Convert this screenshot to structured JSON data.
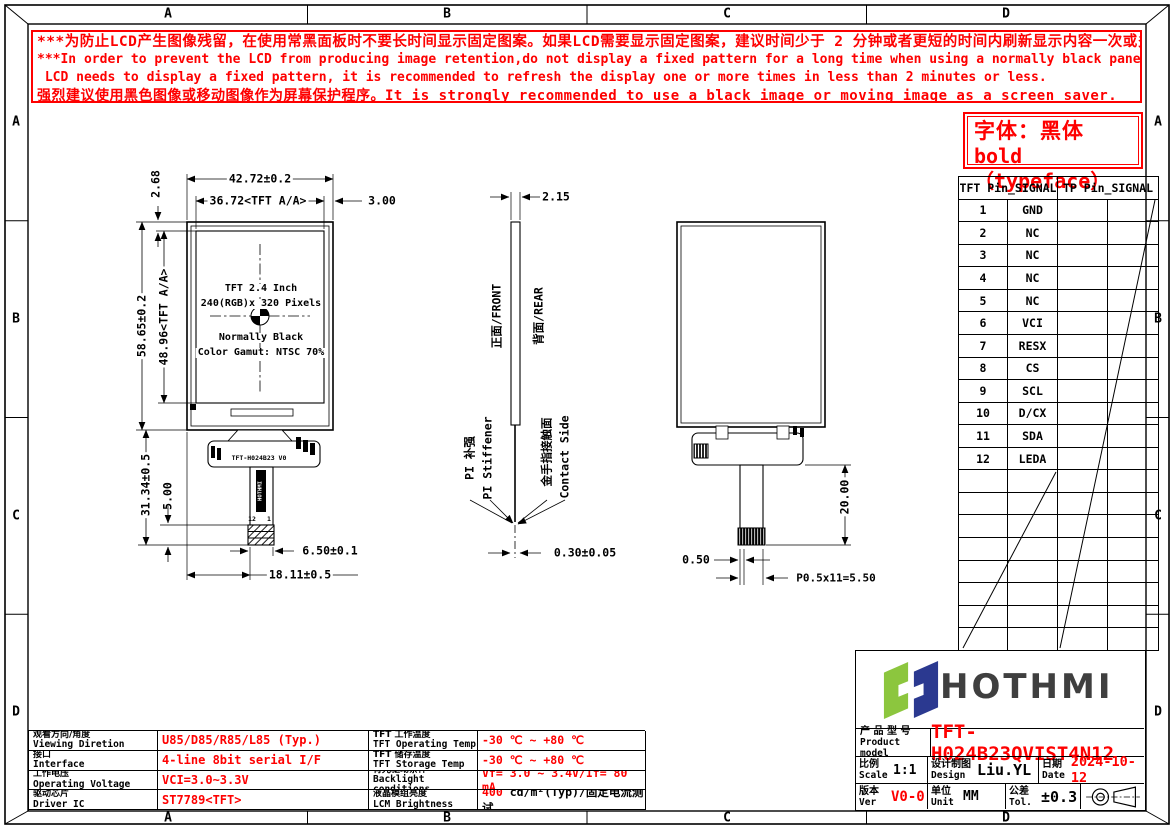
{
  "zones": {
    "cols": [
      "A",
      "B",
      "C",
      "D"
    ],
    "rows": [
      "A",
      "B",
      "C",
      "D"
    ]
  },
  "colors": {
    "warning_red": "#fe0000",
    "logo_green": "#8cc63e",
    "logo_navy": "#2b3990",
    "logo_gray": "#3f3f3f"
  },
  "warning": {
    "lines": [
      "***为防止LCD产生图像残留，在使用常黑面板时不要长时间显示固定图案。如果LCD需要显示固定图案，建议时间少于 2 分钟或者更短的时间内刷新显示内容一次或多次。",
      "***In order to prevent the LCD from producing image retention,do not display a fixed pattern for a long time when using a normally black panel.If the",
      " LCD needs to display a fixed pattern, it is recommended to refresh the display one or more times in less than 2 minutes or less.",
      "强烈建议使用黑色图像或移动图像作为屏幕保护程序。It is strongly recommended to use a black image or moving image as a screen saver."
    ]
  },
  "font_note": {
    "line1": "字体：黑体",
    "line2": "bold（typeface）"
  },
  "pin_table": {
    "header_tft": "TFT Pin_SIGNAL",
    "header_tp": "TP Pin_SIGNAL",
    "rows": [
      {
        "pin": "1",
        "signal": "GND"
      },
      {
        "pin": "2",
        "signal": "NC"
      },
      {
        "pin": "3",
        "signal": "NC"
      },
      {
        "pin": "4",
        "signal": "NC"
      },
      {
        "pin": "5",
        "signal": "NC"
      },
      {
        "pin": "6",
        "signal": "VCI"
      },
      {
        "pin": "7",
        "signal": "RESX"
      },
      {
        "pin": "8",
        "signal": "CS"
      },
      {
        "pin": "9",
        "signal": "SCL"
      },
      {
        "pin": "10",
        "signal": "D/CX"
      },
      {
        "pin": "11",
        "signal": "SDA"
      },
      {
        "pin": "12",
        "signal": "LEDA"
      }
    ]
  },
  "front_view": {
    "labels": {
      "line1": "TFT 2.4 Inch",
      "line2": "240(RGB)x 320 Pixels",
      "line3": "Normally Black",
      "line4": "Color Gamut: NTSC 70%"
    },
    "fpc_label": "TFT-H024B23 V0",
    "fpc_logo": "HOTHMI",
    "pin_left": "12",
    "pin_right": "1",
    "dims": {
      "width": "42.72±0.2",
      "aa_width": "36.72<TFT A/A>",
      "right_margin": "3.00",
      "top_margin": "2.68",
      "height": "58.65±0.2",
      "aa_height": "48.96<TFT A/A>",
      "fpc_length": "31.34±0.5",
      "tail_offset": "5.00",
      "tail_width": "6.50±0.1",
      "tail_center": "18.11±0.5"
    }
  },
  "side_view": {
    "labels": {
      "front": "正面/FRONT",
      "rear": "背面/REAR",
      "stiffener_cn": "PI 补强",
      "stiffener_en": "PI Stiffener",
      "contact_cn": "金手指接触面",
      "contact_en": "Contact Side"
    },
    "dims": {
      "thickness": "2.15",
      "fpc_thickness": "0.30±0.05"
    }
  },
  "rear_view": {
    "dims": {
      "tail_length": "20.00",
      "wall": "0.50",
      "pitch": "P0.5x11=5.50"
    }
  },
  "spec_table": {
    "left": [
      {
        "label_cn": "观看方向/角度",
        "label_en": "Viewing Diretion",
        "value": "U85/D85/R85/L85 (Typ.)"
      },
      {
        "label_cn": "接口",
        "label_en": "Interface",
        "value": "4-line 8bit serial I/F"
      },
      {
        "label_cn": "工作电压",
        "label_en": "Operating Voltage",
        "value": "VCI=3.0~3.3V"
      },
      {
        "label_cn": "驱动芯片",
        "label_en": "Driver IC",
        "value": "ST7789<TFT>"
      }
    ],
    "right": [
      {
        "label_cn": "TFT 工作温度",
        "label_en": "TFT Operating Temp",
        "value_red": "-30 ℃ ~ +80 ℃",
        "value_black": ""
      },
      {
        "label_cn": "TFT 储存温度",
        "label_en": "TFT Storage Temp",
        "value_red": "-30 ℃ ~ +80 ℃",
        "value_black": ""
      },
      {
        "label_cn": "背光驱动条件",
        "label_en": "Backlight conditions",
        "value_red": "Vf= 3.0 ~ 3.4V/If= 80 mA",
        "value_black": ""
      },
      {
        "label_cn": "液晶模组亮度",
        "label_en": "LCM Brightness",
        "value_red": "400",
        "value_black": " cd/m²(Typ)/固定电流测试"
      }
    ]
  },
  "title_block": {
    "logo_text": "HOTHMI",
    "product_label_cn": "产 品 型 号",
    "product_label_en": "Product model",
    "product_value": "TFT-H024B23QVIST4N12",
    "scale_cn": "比例",
    "scale_en": "Scale",
    "scale_value": "1:1",
    "design_cn": "设计制图",
    "design_en": "Design",
    "design_value": "Liu.YL",
    "date_cn": "日期",
    "date_en": "Date",
    "date_value": "2024-10-12",
    "ver_cn": "版本",
    "ver_en": "Ver",
    "ver_value": "V0-0",
    "unit_cn": "单位",
    "unit_en": "Unit",
    "unit_value": "MM",
    "tol_cn": "公差",
    "tol_en": "Tol.",
    "tol_value": "±0.3"
  }
}
